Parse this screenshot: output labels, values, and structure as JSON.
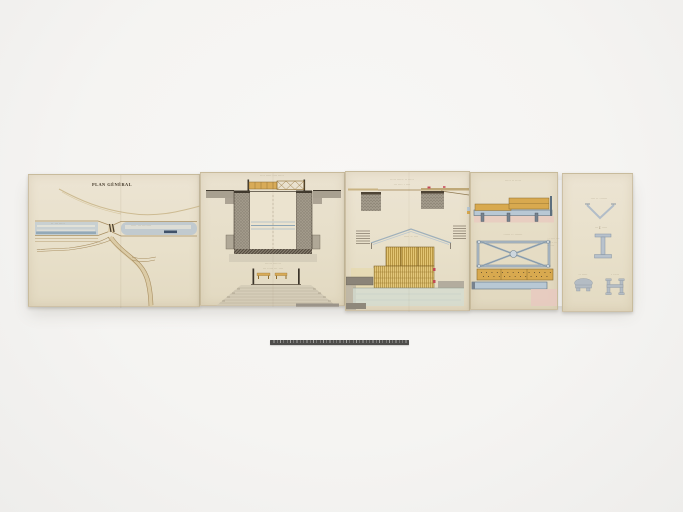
{
  "image": {
    "subject": "archival photograph of a folded five-panel hand-drawn engineering plan (watercolor and ink on cream paper) with a photographic scale bar below",
    "background_color": "#f5f4f2",
    "paper_color": "#e8e0ca"
  },
  "colors": {
    "timber_orange": "#d8a94f",
    "timber_outline": "#8a6a2e",
    "timber_yellow": "#e3c573",
    "metal_blue": "#b8c8d4",
    "metal_outline": "#6d7f8e",
    "wash_pink": "#e8c9bf",
    "wash_bluegreen": "#d3dcd2",
    "canal_blue": "#bcc8cf",
    "canal_navy": "#40526a",
    "masonry_gray": "#a29a8b",
    "ink_dark": "#3f382d",
    "ink_brown": "#8a7347",
    "red_accent": "#c24a56",
    "scale_bar": "#4e4d4b"
  },
  "panel_plan": {
    "title": "PLAN GÉNÉRAL",
    "label_canal_left": "·· ··· ·····",
    "label_canal_right": "····· ··· ········",
    "label_road_left": "··· ····",
    "label_road_lower": "·· ·····"
  },
  "panel_sections": {
    "caption_top": "···· ····· ···· ·····",
    "caption_mid_line1": "······ ·······",
    "caption_mid_line2": "··· ····· ··· ····"
  },
  "panel_long_sections": {
    "caption_top_line1": "····· ······ ·· ·····",
    "caption_top_line2": "··· ···· · ····",
    "caption_gable": "····· ·· ····"
  },
  "panel_deck_details": {
    "caption_top": "····· ·· ·····",
    "caption_mid": "······ ·· ·······",
    "annotation_line1": "··· ····· ····",
    "annotation_line2": "···· ·· ···",
    "annotation_line3": "·· ·····"
  },
  "panel_profiles": {
    "caption_v": "···· ·· ·······",
    "caption_ibeam": "··· I ·····",
    "caption_profile_left": "·· ·····",
    "caption_profile_right": "· ·····"
  }
}
